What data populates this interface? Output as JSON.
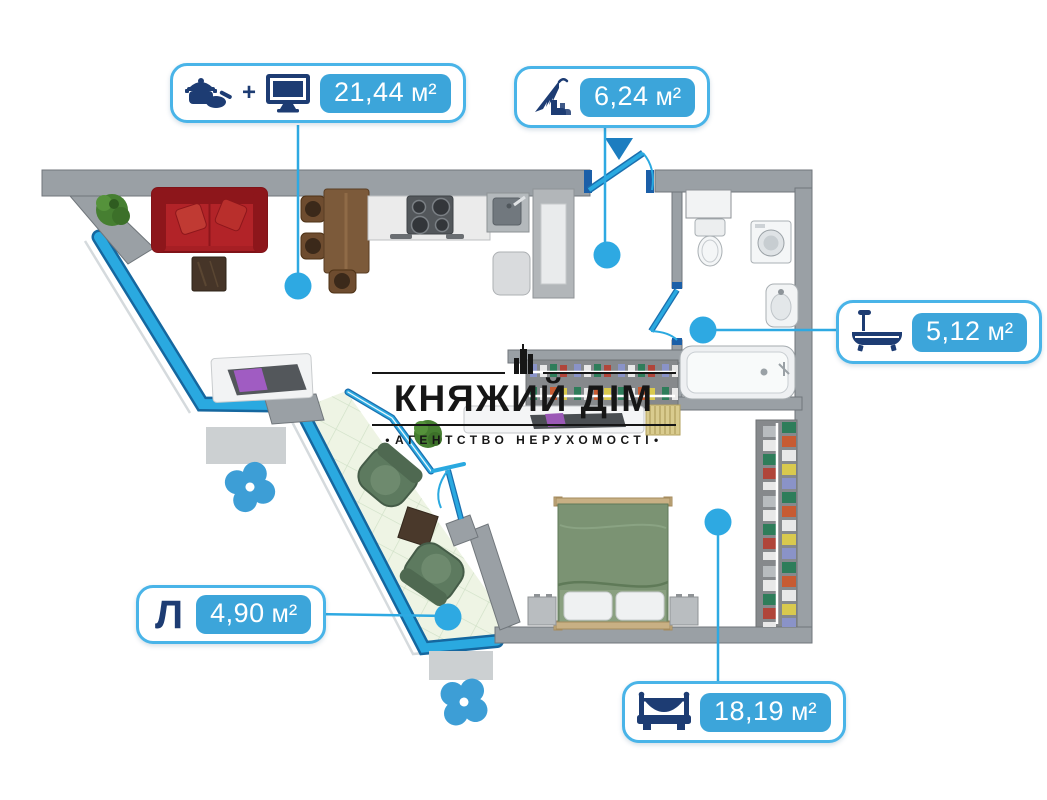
{
  "watermark": {
    "title": "КНЯЖИЙ ДІМ",
    "subtitle": "АГЕНТСТВО НЕРУХОМОСТІ",
    "bullet": "•"
  },
  "labels": {
    "kitchen_living": {
      "area": "21,44",
      "unit": "м²",
      "plus": "+"
    },
    "hallway": {
      "area": "6,24",
      "unit": "м²"
    },
    "bathroom": {
      "area": "5,12",
      "unit": "м²"
    },
    "loggia": {
      "letter": "Л",
      "area": "4,90",
      "unit": "м²"
    },
    "bedroom": {
      "area": "18,19",
      "unit": "м²"
    }
  },
  "icons": {
    "kitchen": "pot-icon",
    "living": "tv-icon",
    "hallway": "umbrella-boots-icon",
    "bathroom": "bathtub-icon",
    "bedroom": "bed-icon",
    "ventilation": "fan-icon",
    "entrance": "entrance-arrow-icon",
    "agency": "building-icon"
  },
  "colors": {
    "accent": "#2ea9e2",
    "pill_fill": "#3ca5da",
    "label_border": "#49b4e8",
    "icon_navy": "#1d3c73",
    "wall_gray": "#9aa0a5",
    "glazing_blue": "#2aa9e0",
    "balcony_floor": "#eef4e4",
    "sofa_red": "#a61f24",
    "bed_green": "#7b9373",
    "text_dark": "#161616"
  }
}
